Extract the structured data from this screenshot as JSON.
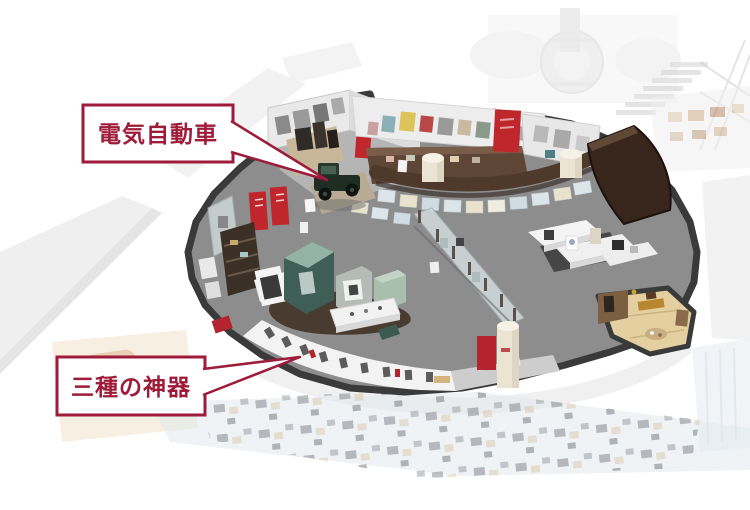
{
  "page": {
    "background": "#ffffff"
  },
  "palette": {
    "floor": "#8d8d8d",
    "outline": "#3a3a3a",
    "partition_wall": "#4e392b",
    "partition_wall_dark": "#38261c",
    "callout_red": "#9e1b3a",
    "banner_red": "#c0272d",
    "tatami": "#e3cf9f",
    "column_cream": "#ece4d2",
    "gallery_white": "#f3f3f3",
    "glass": "#d6e0e2",
    "teal_exhibit": "#3f5e56"
  },
  "callouts": [
    {
      "label": "電気自動車"
    },
    {
      "label": "三種の神器"
    }
  ]
}
